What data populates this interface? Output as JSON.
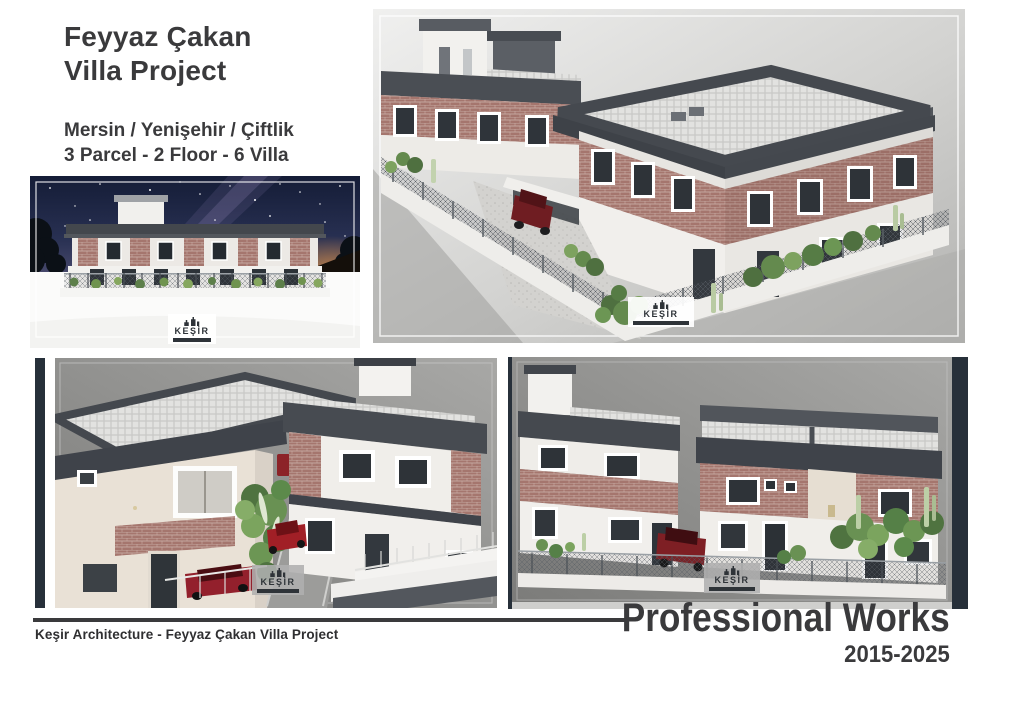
{
  "header": {
    "title_line1": "Feyyaz Çakan",
    "title_line2": "Villa Project",
    "location": "Mersin / Yenişehir / Çiftlik",
    "specs": "3 Parcel - 2 Floor - 6 Villa"
  },
  "watermark": {
    "name": "KEŞİR"
  },
  "footer": {
    "credit": "Keşir Architecture -  Feyyaz Çakan Villa Project",
    "title": "Professional Works",
    "years": "2015-2025"
  },
  "colors": {
    "text_dark": "#3a3a3c",
    "frame_bar_dark": "#27303a",
    "roof_gray": "#45494f",
    "brick": "#a5766e",
    "panel_gray": "#8f8f8d",
    "car_red": "#7e1f24",
    "greenery": "#699153",
    "night_sky": "#283052"
  }
}
